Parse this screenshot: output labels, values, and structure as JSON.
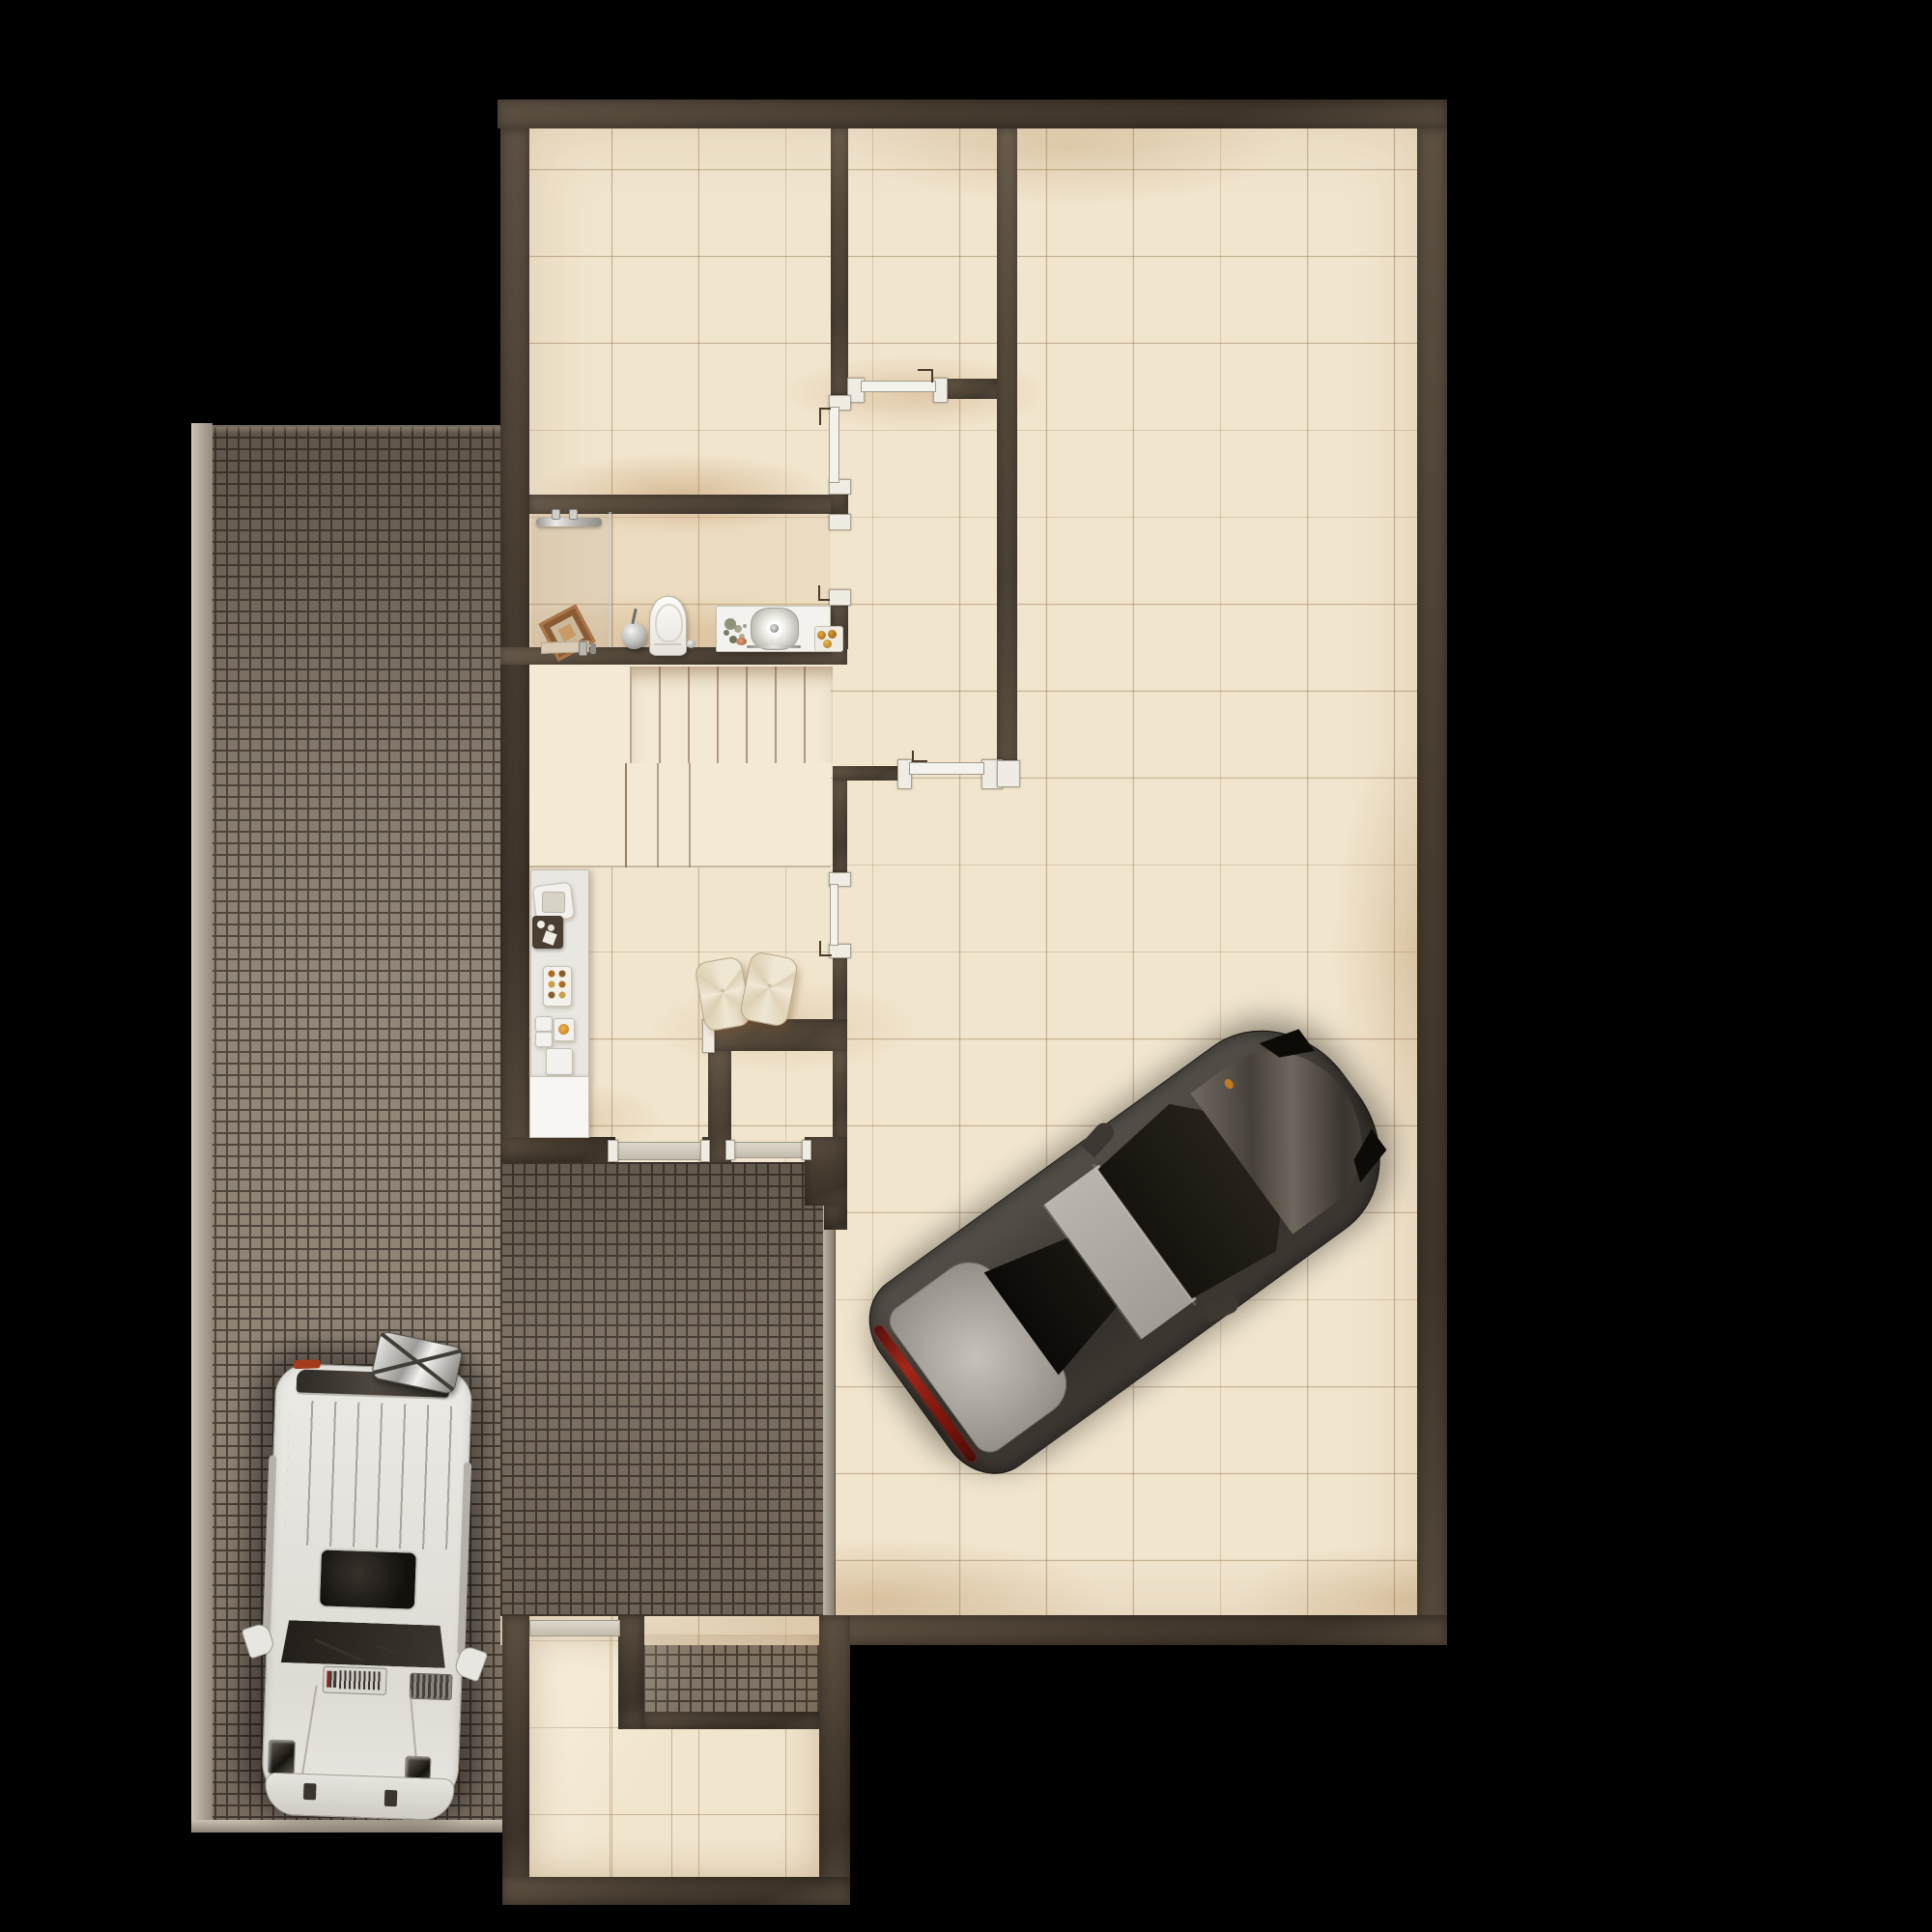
{
  "scene": {
    "type": "architectural-floor-plan-top-view",
    "background": "black",
    "areas": [
      {
        "name": "driveway",
        "surface": "cobblestone",
        "contains": "white-suv"
      },
      {
        "name": "room-top-left",
        "surface": "beige-tile"
      },
      {
        "name": "corridor-room",
        "surface": "beige-tile"
      },
      {
        "name": "garage-hall",
        "surface": "beige-tile",
        "contains": "dark-sedan"
      },
      {
        "name": "bathroom",
        "fixtures": [
          "towel-rail",
          "leaning-mirror",
          "vase",
          "toilet",
          "vanity-sink",
          "glass-partition"
        ]
      },
      {
        "name": "staircase",
        "upper-flight-treads": 7,
        "lower-steps": 2,
        "landing": true
      },
      {
        "name": "kitchenette",
        "fixtures": [
          "counter",
          "cutting-board",
          "dark-tray",
          "jar-tray",
          "cooktop-knobs",
          "cabinet"
        ]
      },
      {
        "name": "entry-vestibule"
      },
      {
        "name": "storage-room-bottom",
        "surface": "beige-tile"
      }
    ],
    "vehicles": [
      {
        "name": "white-suv",
        "color": "#e9e7e1",
        "location": "driveway",
        "heading": "front-down",
        "roof_box": "chrome-with-x-straps",
        "sunroof": true
      },
      {
        "name": "dark-sedan",
        "color": "#3b3631",
        "roof_color": "#b4b0a9",
        "taillight": "#8e2012",
        "location": "garage-hall",
        "rotation_deg": -36
      }
    ],
    "doors": [
      {
        "name": "corridor-door",
        "state": "closed-white-leaf"
      },
      {
        "name": "room-a-door",
        "state": "closed-white-leaf"
      },
      {
        "name": "bathroom-door",
        "state": "open"
      },
      {
        "name": "hall-door",
        "state": "closed-white-leaf"
      },
      {
        "name": "garage-side-door",
        "state": "open"
      },
      {
        "name": "kitchen-exterior-openings",
        "count": 2,
        "sills": true
      },
      {
        "name": "storage-room-door",
        "sills": true
      }
    ],
    "objects": [
      {
        "name": "floor-cushions",
        "count": 2,
        "color": "cream"
      }
    ]
  },
  "palette": {
    "bg": "#000000",
    "wall-a": "#6b5d4e",
    "wall-b": "#4b4034",
    "wall-c": "#3e342a",
    "tile": "#f1e5cd",
    "tile-hi": "#f5ecd9",
    "cobble-stone": "#8d8172",
    "cobble-gap": "#4b4137",
    "curb": "#c8c0b2",
    "fixture": "#f4f3ef",
    "sill": "#d6d1c5",
    "chrome": "#cfcecb",
    "red": "#8e2012",
    "suv": "#e9e7e1",
    "car": "#3b3631",
    "car-silver": "#b4b0a9",
    "glass": "#131008",
    "amber": "#c27a1c"
  }
}
